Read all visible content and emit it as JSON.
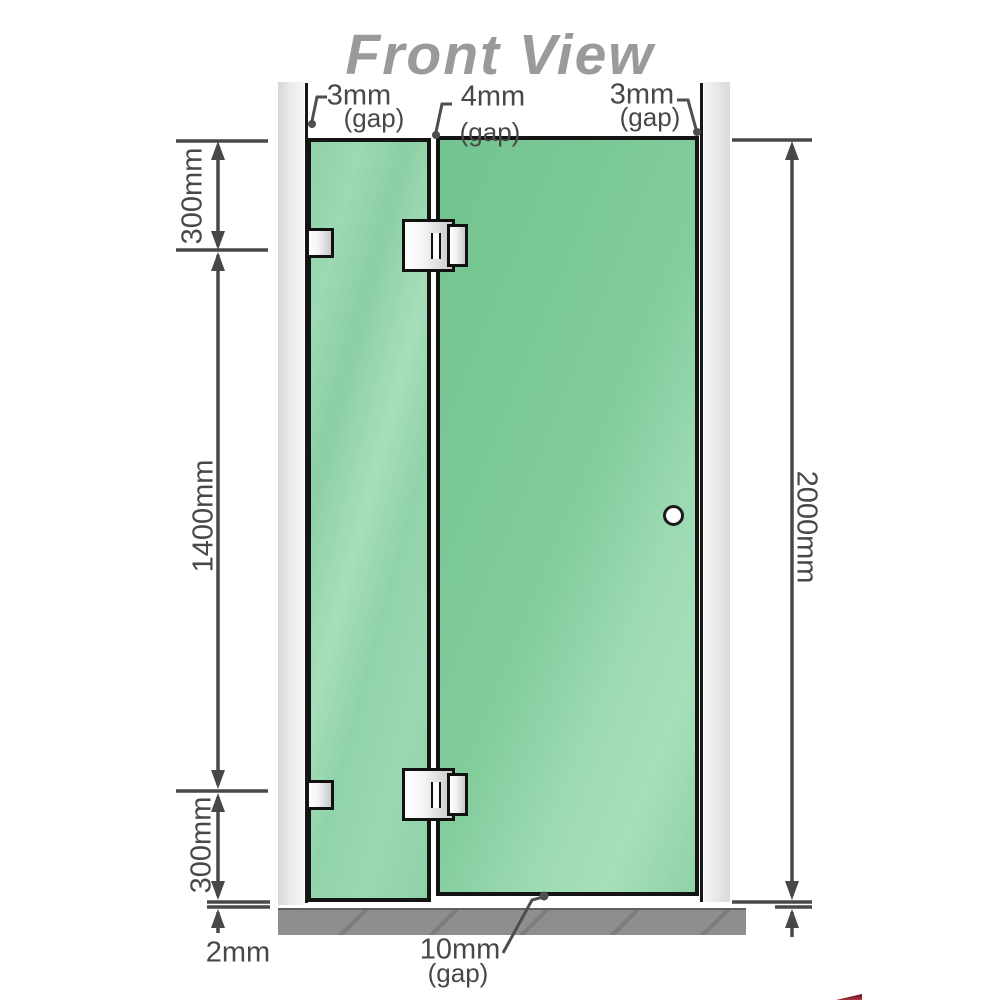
{
  "title": "Front View",
  "colors": {
    "title-gray": "#9a9a9a",
    "dim-gray": "#484848",
    "outline-black": "#141414",
    "glass-fixed-green": "#92d4ab",
    "glass-door-green": "#7ecb9c",
    "wall-gray": "#e3e3e3",
    "floor-gray": "#8e8e8e",
    "brand-red": "#8e1f2f"
  },
  "dimensions": {
    "top_gaps": [
      {
        "label": "3mm",
        "sub": "(gap)"
      },
      {
        "label": "4mm",
        "sub": "(gap)"
      },
      {
        "label": "3mm",
        "sub": "(gap)"
      }
    ],
    "left": [
      {
        "label": "300mm"
      },
      {
        "label": "1400mm"
      },
      {
        "label": "300mm"
      }
    ],
    "right": {
      "label": "2000mm"
    },
    "bottom": {
      "floor_gap": {
        "label": "2mm"
      },
      "door_gap": {
        "label": "10mm",
        "sub": "(gap)"
      }
    }
  }
}
